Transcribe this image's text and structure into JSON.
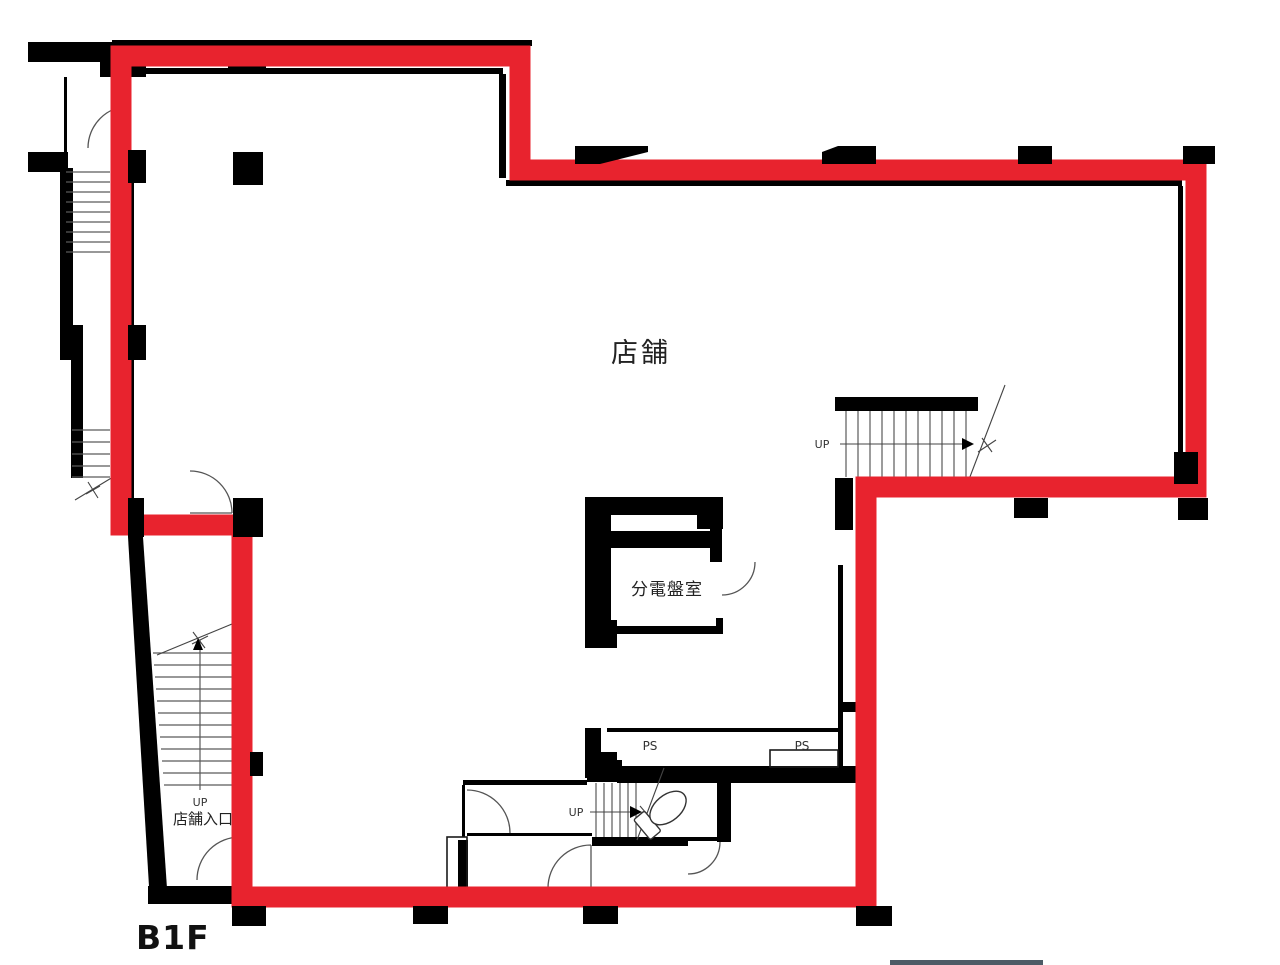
{
  "plan": {
    "floor_label": "B1F",
    "labels": {
      "store": "店舗",
      "electrical_room": "分電盤室",
      "pipe_shaft_1": "PS",
      "pipe_shaft_2": "PS",
      "up_right_stair": "UP",
      "up_center_stair": "UP",
      "up_entrance": "UP",
      "store_entrance": "店舗入口"
    },
    "colors": {
      "highlight_outline": "#e8232e",
      "wall": "#000000",
      "stair_line": "#5a5a5a",
      "break_bar": "#4d5b66",
      "background": "#ffffff"
    },
    "highlight": {
      "points": "121,56 520,56 520,170 1196,170 1196,487 866,487 866,897 242,897 242,525 121,525",
      "stroke_width": "21"
    }
  }
}
